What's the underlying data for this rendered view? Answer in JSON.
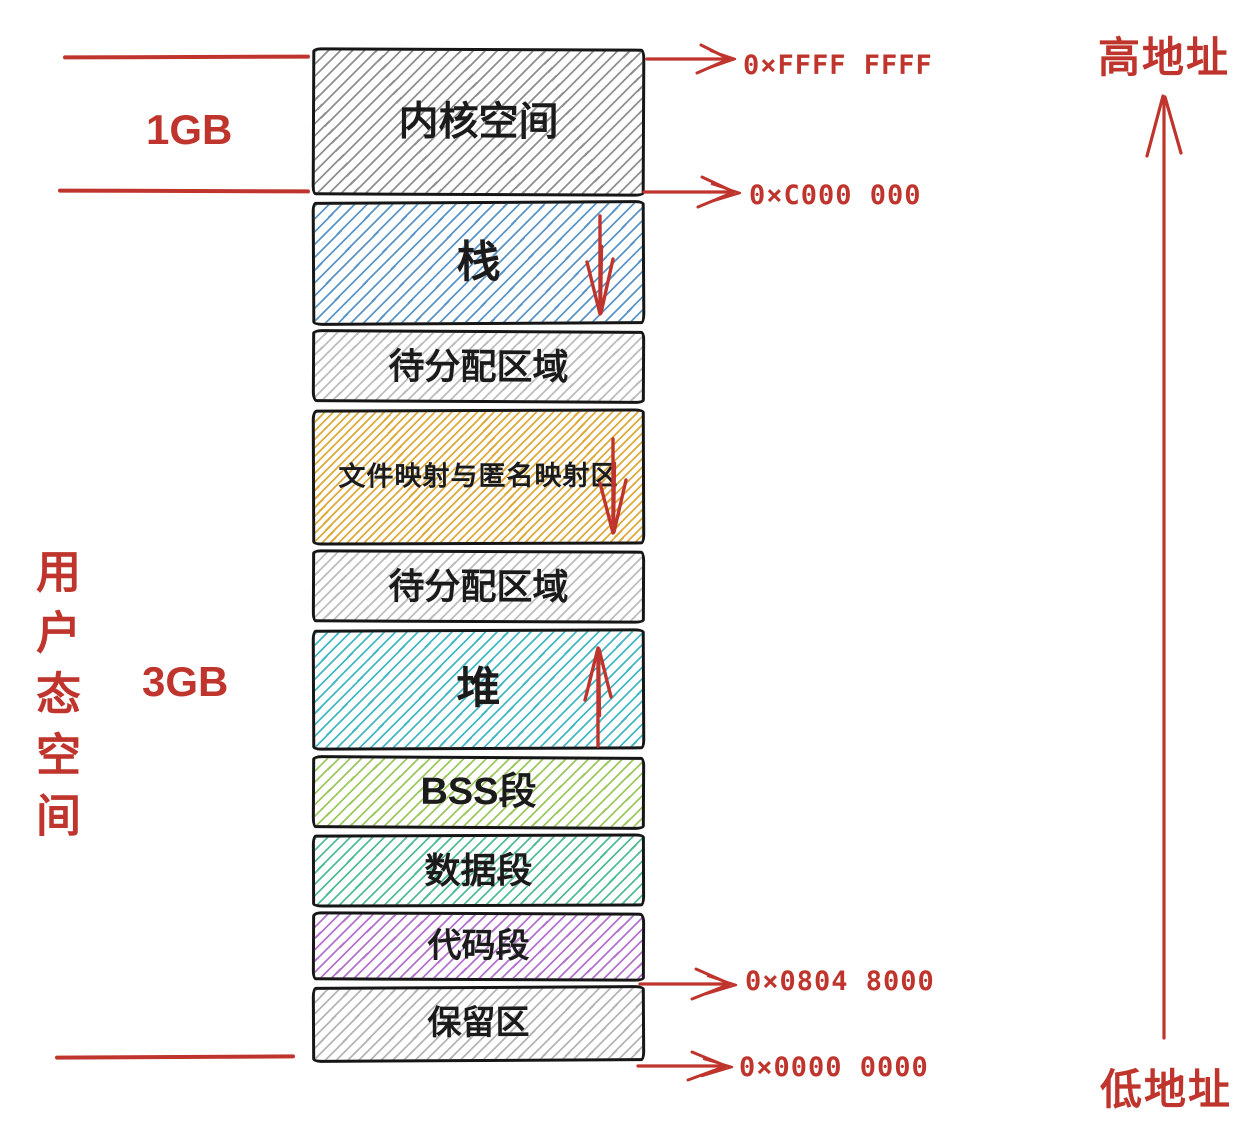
{
  "diagram": {
    "accent_red": "#bf352d",
    "left_panel": {
      "user_space_vertical_label": "用户态空间",
      "kernel_size_label": "1GB",
      "user_size_label": "3GB"
    },
    "right_panel": {
      "high_address_label": "高地址",
      "low_address_label": "低地址"
    },
    "blocks": [
      {
        "id": "kernel-space",
        "label": "内核空间",
        "hatch": "#8f8f8f",
        "arrow": null
      },
      {
        "id": "stack",
        "label": "栈",
        "hatch": "#5a96c8",
        "arrow": "down"
      },
      {
        "id": "unallocated-1",
        "label": "待分配区域",
        "hatch": "#bdbdbd",
        "arrow": null
      },
      {
        "id": "mmap-region",
        "label": "文件映射与匿名映射区",
        "hatch": "#dfaa3c",
        "arrow": "down"
      },
      {
        "id": "unallocated-2",
        "label": "待分配区域",
        "hatch": "#bdbdbd",
        "arrow": null
      },
      {
        "id": "heap",
        "label": "堆",
        "hatch": "#45b8c6",
        "arrow": "up"
      },
      {
        "id": "bss-segment",
        "label": "BSS段",
        "hatch": "#9ec860",
        "arrow": null
      },
      {
        "id": "data-segment",
        "label": "数据段",
        "hatch": "#52bd98",
        "arrow": null
      },
      {
        "id": "code-segment",
        "label": "代码段",
        "hatch": "#b573cf",
        "arrow": null
      },
      {
        "id": "reserved-area",
        "label": "保留区",
        "hatch": "#b5b5b5",
        "arrow": null
      }
    ],
    "addresses": [
      {
        "id": "addr-top",
        "value": "0×FFFF FFFF"
      },
      {
        "id": "addr-kernel-base",
        "value": "0×C000 000"
      },
      {
        "id": "addr-code-base",
        "value": "0×0804 8000"
      },
      {
        "id": "addr-zero",
        "value": "0×0000 0000"
      }
    ]
  }
}
